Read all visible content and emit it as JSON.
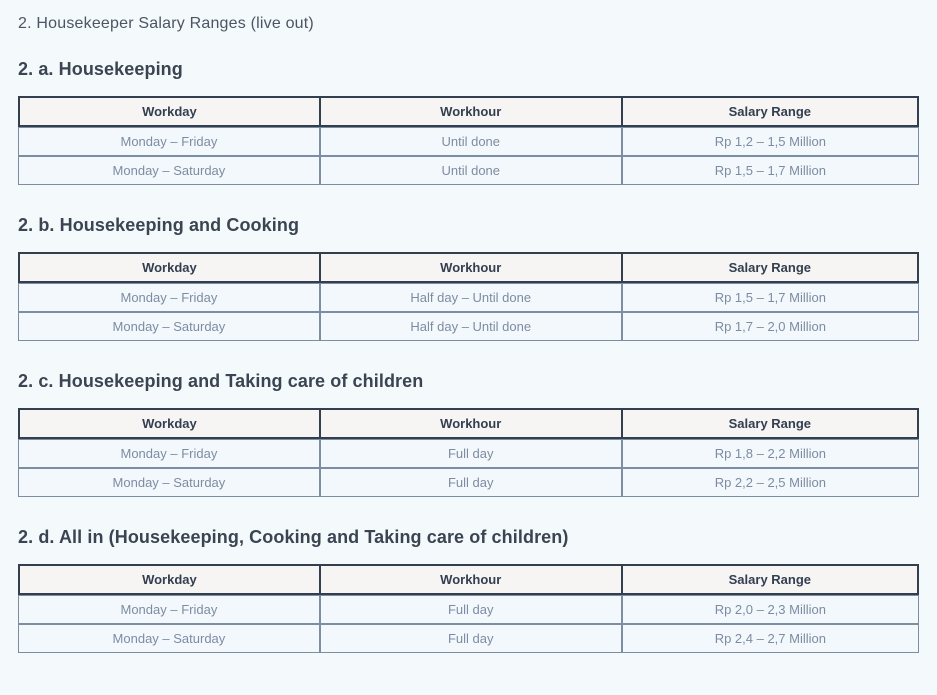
{
  "page": {
    "title": "2. Housekeeper Salary Ranges (live out)"
  },
  "theme": {
    "page_background": "#f4f9fc",
    "heading_text": "#3b4552",
    "title_text": "#4b5563",
    "header_cell_background": "#f6f5f4",
    "header_cell_border": "#333e4f",
    "header_cell_text": "#333e4f",
    "body_cell_background": "#f3f8fc",
    "body_cell_border": "#7d8ea3",
    "body_cell_text": "#7d8ca2"
  },
  "table_headers": [
    "Workday",
    "Workhour",
    "Salary Range"
  ],
  "sections": [
    {
      "heading": "2. a. Housekeeping",
      "rows": [
        [
          "Monday – Friday",
          "Until done",
          "Rp 1,2 – 1,5 Million"
        ],
        [
          "Monday – Saturday",
          "Until done",
          "Rp 1,5 – 1,7 Million"
        ]
      ]
    },
    {
      "heading": "2. b. Housekeeping and Cooking",
      "rows": [
        [
          "Monday – Friday",
          "Half day – Until done",
          "Rp 1,5 – 1,7 Million"
        ],
        [
          "Monday – Saturday",
          "Half day – Until done",
          "Rp 1,7 – 2,0 Million"
        ]
      ]
    },
    {
      "heading": "2. c. Housekeeping and Taking care of children",
      "rows": [
        [
          "Monday – Friday",
          "Full day",
          "Rp 1,8 – 2,2 Million"
        ],
        [
          "Monday – Saturday",
          "Full day",
          "Rp 2,2 – 2,5 Million"
        ]
      ]
    },
    {
      "heading": "2. d. All in (Housekeeping, Cooking and Taking care of children)",
      "rows": [
        [
          "Monday – Friday",
          "Full day",
          "Rp 2,0 – 2,3 Million"
        ],
        [
          "Monday – Saturday",
          "Full day",
          "Rp 2,4 – 2,7 Million"
        ]
      ]
    }
  ]
}
